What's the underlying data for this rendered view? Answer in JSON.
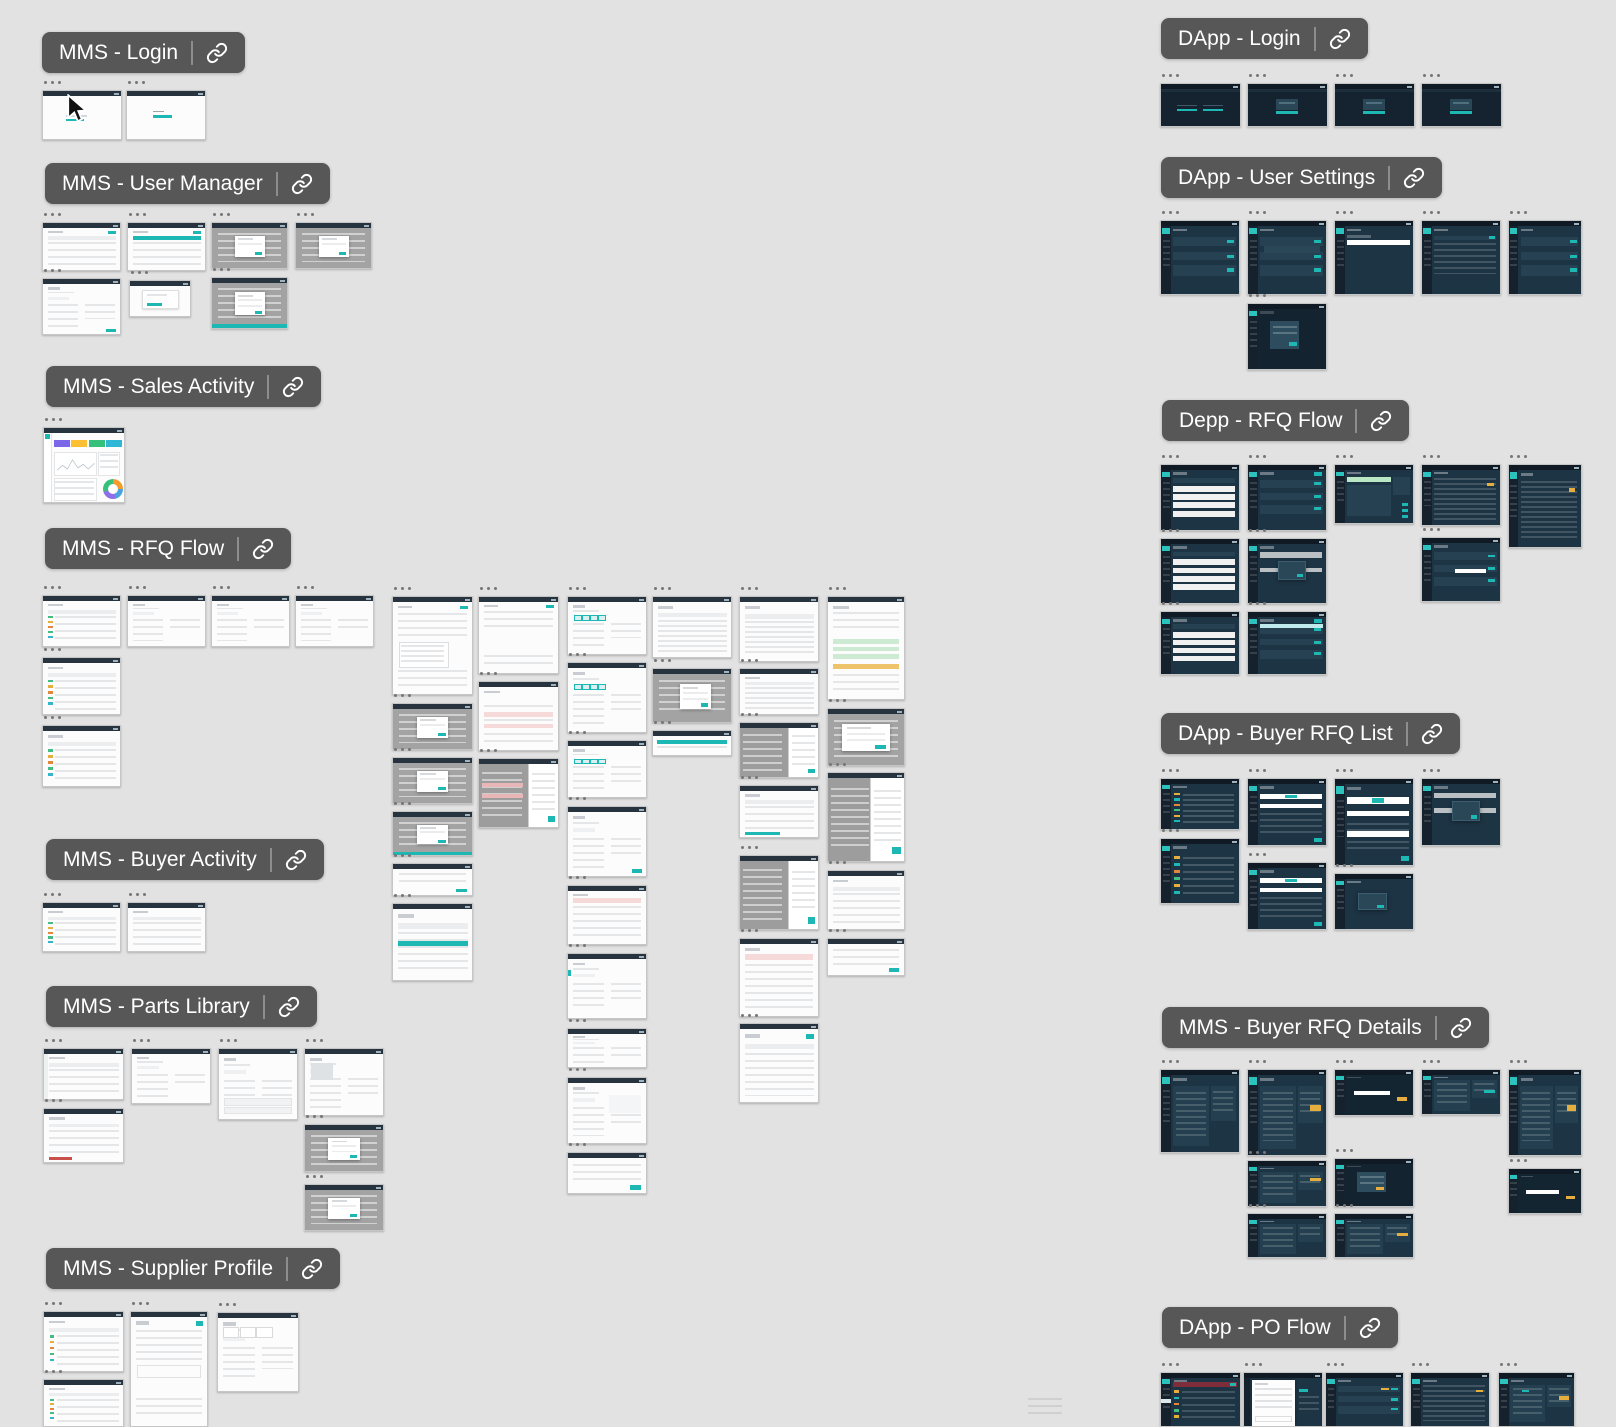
{
  "app": {
    "description_label": "design canvas overview",
    "frame_title_placeholder": "...",
    "section_link_icon": "link-chain"
  },
  "palette": {
    "canvas_bg": "#e2e2e2",
    "pill_bg": "#575757",
    "pill_text": "#ffffff",
    "teal_accent": "#1eb8b4",
    "yellow_accent": "#e6ae3c",
    "orange_accent": "#e2873b",
    "green_accent": "#43bd83",
    "cyan_accent": "#35b5c9",
    "red_accent": "#c9504a",
    "dark_red_banner": "#7e2d3b",
    "pink_row": "#f6d9d9",
    "green_row": "#cdebd3",
    "gray_overlay": "#a3a3a3",
    "dark_screen_bg": "#1d3444",
    "dark_sidebar": "#15222d",
    "dark_panel": "#264252",
    "dashboard_cards": [
      "#7b68e8",
      "#fdc032",
      "#35c07c",
      "#2fb7d6"
    ],
    "donut_colors": [
      "#f39c2d",
      "#4aa3df",
      "#8e6fe8",
      "#35c07c"
    ]
  },
  "cursor": {
    "x": 64,
    "y": 94
  },
  "thumb_format": "x,y,w,h,variant,flags",
  "sections": [
    {
      "label": "MMS - Login",
      "x": 42,
      "y": 32,
      "thumbs": [
        [
          42,
          90,
          80,
          50,
          "login1",
          ""
        ],
        [
          126,
          90,
          80,
          50,
          "login2",
          ""
        ]
      ]
    },
    {
      "label": "MMS - User Manager",
      "x": 45,
      "y": 163,
      "thumbs": [
        [
          42,
          222,
          79,
          49,
          "table",
          "head"
        ],
        [
          127,
          222,
          79,
          49,
          "table",
          "tealhead"
        ],
        [
          211,
          222,
          77,
          47,
          "graymodal",
          ""
        ],
        [
          295,
          222,
          77,
          47,
          "graymodal",
          ""
        ],
        [
          42,
          278,
          79,
          57,
          "form",
          "tealbr"
        ],
        [
          129,
          280,
          62,
          37,
          "modalsmall",
          ""
        ],
        [
          211,
          277,
          77,
          52,
          "graymodal",
          "tealbar"
        ]
      ]
    },
    {
      "label": "MMS - Sales Activity",
      "x": 46,
      "y": 366,
      "thumbs": [
        [
          43,
          427,
          82,
          76,
          "statsboard",
          ""
        ]
      ]
    },
    {
      "label": "MMS - RFQ Flow",
      "x": 45,
      "y": 528,
      "thumbs": [
        [
          42,
          595,
          79,
          52,
          "table",
          "chips"
        ],
        [
          127,
          595,
          79,
          52,
          "form",
          ""
        ],
        [
          211,
          595,
          79,
          52,
          "form",
          "lines"
        ],
        [
          295,
          595,
          79,
          52,
          "form",
          "lines"
        ],
        [
          42,
          657,
          79,
          58,
          "table",
          "chips"
        ],
        [
          42,
          725,
          79,
          62,
          "table",
          "chips"
        ],
        [
          392,
          596,
          81,
          99,
          "longform",
          "cal"
        ],
        [
          392,
          703,
          81,
          47,
          "graymodal",
          ""
        ],
        [
          392,
          757,
          81,
          47,
          "graymodal",
          ""
        ],
        [
          392,
          811,
          81,
          45,
          "graymodal",
          "tealbar"
        ],
        [
          392,
          863,
          81,
          33,
          "smalldoc",
          ""
        ],
        [
          392,
          903,
          81,
          78,
          "table",
          "tealwide"
        ],
        [
          478,
          596,
          81,
          78,
          "longform",
          ""
        ],
        [
          478,
          681,
          81,
          70,
          "pinkrows",
          ""
        ],
        [
          478,
          758,
          81,
          70,
          "splitgray",
          "pink"
        ],
        [
          567,
          596,
          80,
          59,
          "form",
          "pills"
        ],
        [
          567,
          662,
          80,
          71,
          "form",
          "pills"
        ],
        [
          567,
          740,
          80,
          58,
          "form",
          "pills"
        ],
        [
          567,
          806,
          80,
          71,
          "form",
          "tealbr"
        ],
        [
          567,
          885,
          80,
          60,
          "pinkrows",
          "top"
        ],
        [
          567,
          953,
          80,
          66,
          "form",
          "tealside"
        ],
        [
          567,
          1028,
          80,
          40,
          "form",
          ""
        ],
        [
          567,
          1077,
          80,
          67,
          "form",
          "detail"
        ],
        [
          567,
          1152,
          80,
          42,
          "smalldoc",
          ""
        ],
        [
          652,
          596,
          80,
          62,
          "table",
          "dense"
        ],
        [
          652,
          668,
          80,
          55,
          "graymodal",
          "sel"
        ],
        [
          652,
          730,
          80,
          26,
          "tealband",
          ""
        ],
        [
          739,
          596,
          80,
          66,
          "table",
          "dense"
        ],
        [
          739,
          668,
          80,
          47,
          "table",
          "dense"
        ],
        [
          739,
          722,
          80,
          56,
          "splitgray",
          ""
        ],
        [
          739,
          785,
          80,
          53,
          "table",
          "tealprog"
        ],
        [
          739,
          855,
          80,
          75,
          "splitgray",
          "tall"
        ],
        [
          739,
          938,
          80,
          79,
          "pinkrows",
          "banner"
        ],
        [
          739,
          1023,
          80,
          80,
          "table",
          "tealbtn"
        ],
        [
          827,
          596,
          78,
          104,
          "greendoc",
          ""
        ],
        [
          827,
          708,
          78,
          58,
          "graymodal",
          "wide"
        ],
        [
          827,
          772,
          78,
          90,
          "splitgray",
          "graytall"
        ],
        [
          827,
          870,
          78,
          60,
          "table",
          ""
        ],
        [
          827,
          938,
          78,
          38,
          "smalldoc",
          ""
        ]
      ]
    },
    {
      "label": "MMS - Buyer Activity",
      "x": 46,
      "y": 839,
      "thumbs": [
        [
          42,
          902,
          79,
          50,
          "table",
          "chips"
        ],
        [
          127,
          902,
          79,
          50,
          "table",
          ""
        ]
      ]
    },
    {
      "label": "MMS - Parts Library",
      "x": 46,
      "y": 986,
      "thumbs": [
        [
          43,
          1048,
          81,
          52,
          "table",
          "side"
        ],
        [
          131,
          1048,
          80,
          56,
          "form",
          ""
        ],
        [
          218,
          1048,
          80,
          72,
          "form",
          "rows"
        ],
        [
          304,
          1048,
          80,
          68,
          "form",
          "img"
        ],
        [
          43,
          1108,
          81,
          55,
          "table",
          "redbar"
        ],
        [
          304,
          1124,
          80,
          48,
          "graymodal",
          ""
        ],
        [
          304,
          1184,
          80,
          47,
          "graymodal",
          ""
        ]
      ]
    },
    {
      "label": "MMS - Supplier Profile",
      "x": 46,
      "y": 1248,
      "thumbs": [
        [
          43,
          1311,
          81,
          61,
          "table",
          "chips"
        ],
        [
          130,
          1311,
          78,
          116,
          "longform",
          "doc"
        ],
        [
          217,
          1312,
          82,
          80,
          "form",
          "cards"
        ],
        [
          43,
          1379,
          81,
          48,
          "table",
          "chips"
        ]
      ]
    },
    {
      "label": "DApp - Login",
      "x": 1161,
      "y": 18,
      "thumbs": [
        [
          1160,
          83,
          81,
          44,
          "dlogin",
          "two"
        ],
        [
          1247,
          83,
          81,
          44,
          "dlogin",
          ""
        ],
        [
          1334,
          83,
          81,
          44,
          "dlogin",
          ""
        ],
        [
          1421,
          83,
          81,
          44,
          "dlogin",
          ""
        ]
      ]
    },
    {
      "label": "DApp - User Settings",
      "x": 1161,
      "y": 157,
      "thumbs": [
        [
          1160,
          220,
          80,
          75,
          "dpanels",
          ""
        ],
        [
          1247,
          220,
          80,
          75,
          "dpanels",
          "mid"
        ],
        [
          1334,
          220,
          80,
          75,
          "dwhitebanner",
          ""
        ],
        [
          1421,
          220,
          80,
          75,
          "dtable",
          ""
        ],
        [
          1508,
          220,
          74,
          75,
          "dpanels",
          ""
        ],
        [
          1247,
          303,
          80,
          67,
          "dmodal",
          ""
        ]
      ]
    },
    {
      "label": "Depp - RFQ Flow",
      "x": 1162,
      "y": 400,
      "thumbs": [
        [
          1160,
          464,
          80,
          67,
          "dstripes",
          ""
        ],
        [
          1247,
          464,
          80,
          67,
          "dpanels",
          "teal"
        ],
        [
          1334,
          464,
          80,
          60,
          "dgreenbanner",
          ""
        ],
        [
          1421,
          464,
          80,
          62,
          "ddense",
          "yellow"
        ],
        [
          1508,
          464,
          74,
          84,
          "ddense",
          "yellow"
        ],
        [
          1160,
          538,
          80,
          66,
          "dstripes",
          ""
        ],
        [
          1247,
          538,
          80,
          66,
          "dgraymodal",
          "bars"
        ],
        [
          1421,
          537,
          80,
          65,
          "dpanels",
          "input"
        ],
        [
          1160,
          611,
          80,
          64,
          "dstripes",
          ""
        ],
        [
          1247,
          611,
          80,
          64,
          "dpanels",
          "tealtop"
        ]
      ]
    },
    {
      "label": "DApp - Buyer RFQ List",
      "x": 1161,
      "y": 713,
      "thumbs": [
        [
          1160,
          778,
          80,
          52,
          "dchips",
          ""
        ],
        [
          1247,
          778,
          80,
          68,
          "dwhitebars",
          ""
        ],
        [
          1334,
          778,
          80,
          88,
          "dwhitebars",
          "tall"
        ],
        [
          1421,
          778,
          80,
          68,
          "dgraymodal",
          "bars"
        ],
        [
          1160,
          838,
          80,
          66,
          "dchips",
          ""
        ],
        [
          1247,
          862,
          80,
          68,
          "dwhitebars",
          ""
        ],
        [
          1334,
          873,
          80,
          57,
          "dgraymodal",
          "small"
        ]
      ]
    },
    {
      "label": "MMS - Buyer RFQ Details",
      "x": 1162,
      "y": 1007,
      "thumbs": [
        [
          1160,
          1069,
          80,
          84,
          "ddetail",
          ""
        ],
        [
          1247,
          1069,
          80,
          87,
          "ddetail",
          "yellow"
        ],
        [
          1334,
          1069,
          80,
          47,
          "dmodalinput",
          ""
        ],
        [
          1421,
          1069,
          80,
          46,
          "ddetail",
          "teal"
        ],
        [
          1508,
          1069,
          74,
          87,
          "ddetail",
          "yellow"
        ],
        [
          1247,
          1160,
          80,
          47,
          "ddetail",
          "yellowsm"
        ],
        [
          1334,
          1158,
          80,
          49,
          "dmodal",
          "yellow"
        ],
        [
          1508,
          1168,
          74,
          46,
          "dmodalinput",
          ""
        ],
        [
          1247,
          1213,
          80,
          45,
          "ddetail",
          ""
        ],
        [
          1334,
          1213,
          80,
          45,
          "ddetail",
          "yellow"
        ]
      ]
    },
    {
      "label": "DApp - PO Flow",
      "x": 1162,
      "y": 1307,
      "thumbs": [
        [
          1160,
          1372,
          81,
          55,
          "dredbar",
          ""
        ],
        [
          1243,
          1372,
          80,
          55,
          "dinvoice",
          ""
        ],
        [
          1325,
          1372,
          79,
          55,
          "dpanels",
          "yellow"
        ],
        [
          1410,
          1372,
          80,
          55,
          "ddense",
          "yellow"
        ],
        [
          1498,
          1372,
          77,
          55,
          "ddetail",
          "yellowteal"
        ]
      ]
    }
  ]
}
